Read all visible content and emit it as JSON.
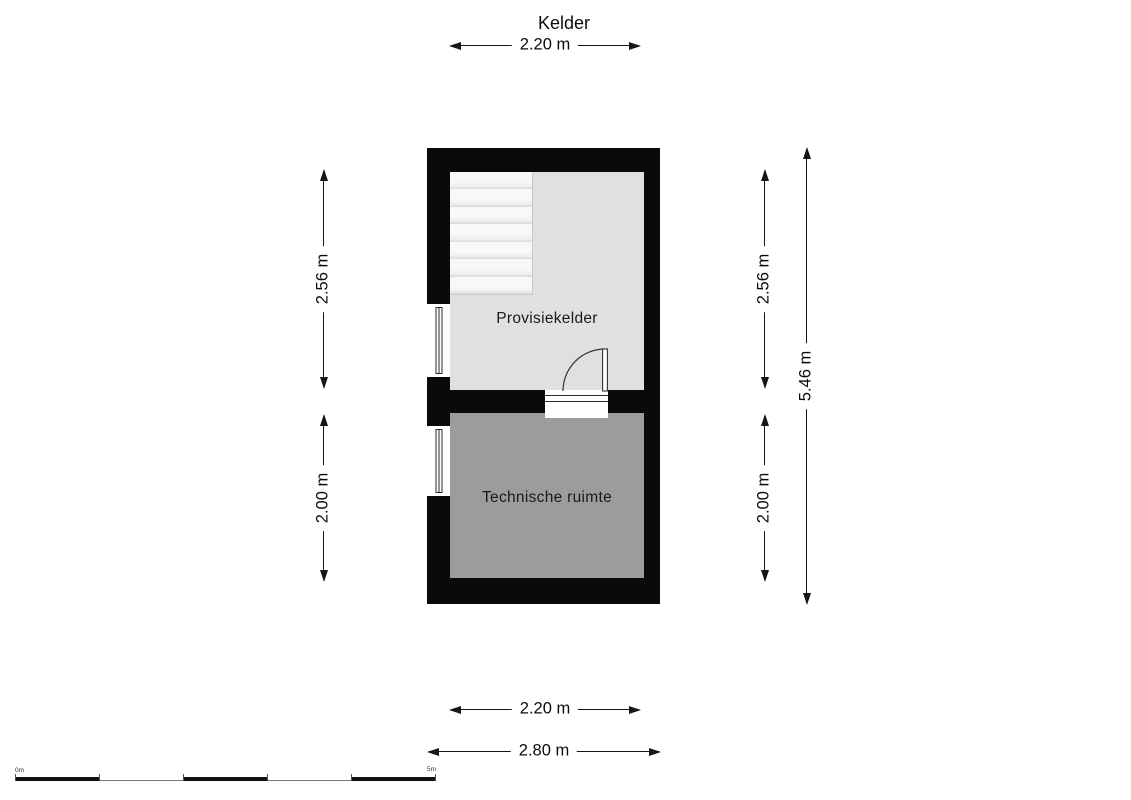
{
  "title": "Kelder",
  "rooms": {
    "upper": {
      "name": "Provisiekelder"
    },
    "lower": {
      "name": "Technische ruimte"
    }
  },
  "dimensions": {
    "top_width": "2.20 m",
    "left_upper": "2.56 m",
    "left_lower": "2.00 m",
    "right_upper": "2.56 m",
    "right_lower": "2.00 m",
    "right_total": "5.46 m",
    "bottom_inner": "2.20 m",
    "bottom_outer": "2.80 m"
  },
  "scale_bar": {
    "start_label": "0m",
    "end_label": "5m"
  },
  "colors": {
    "wall": "#0a0a0a",
    "room_provisiekelder": "#e0e0e0",
    "room_technische_ruimte": "#9c9c9c",
    "stairs": "#f5f5f5",
    "dimension_line": "#161616",
    "background": "#ffffff"
  }
}
